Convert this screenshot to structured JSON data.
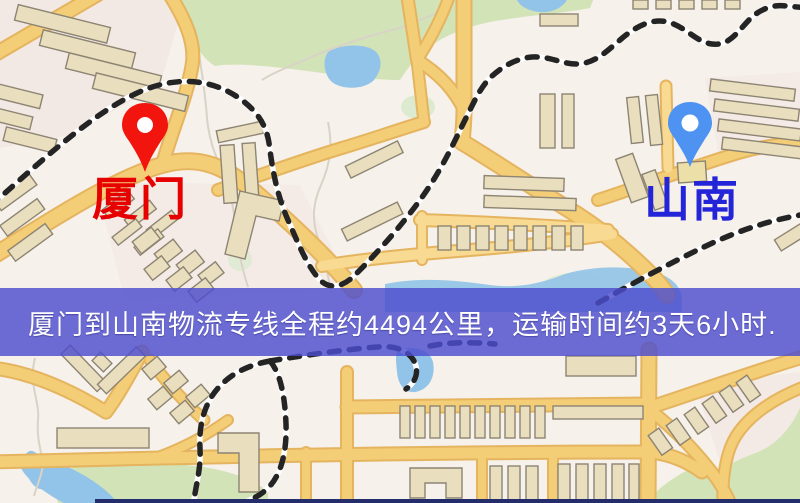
{
  "map": {
    "origin": {
      "label": "厦门",
      "pin_color": "#f2150e",
      "label_color": "#e60000"
    },
    "destination": {
      "label": "山南",
      "pin_color": "#4f93f2",
      "label_color": "#2424d8"
    },
    "banner": {
      "text": "厦门到山南物流专线全程约4494公里，运输时间约3天6小时.",
      "background": "rgba(77,77,206,0.82)",
      "text_color": "#ffffff"
    },
    "colors": {
      "background": "#f6f1ea",
      "road": "#f4cd77",
      "road_casing": "#e5b45f",
      "building": "#e9dfbe",
      "building_outline": "#8d8473",
      "green": "#d3e3b8",
      "water": "#92c3e8",
      "railway": "#242424",
      "border_line": "#232d6b"
    }
  }
}
